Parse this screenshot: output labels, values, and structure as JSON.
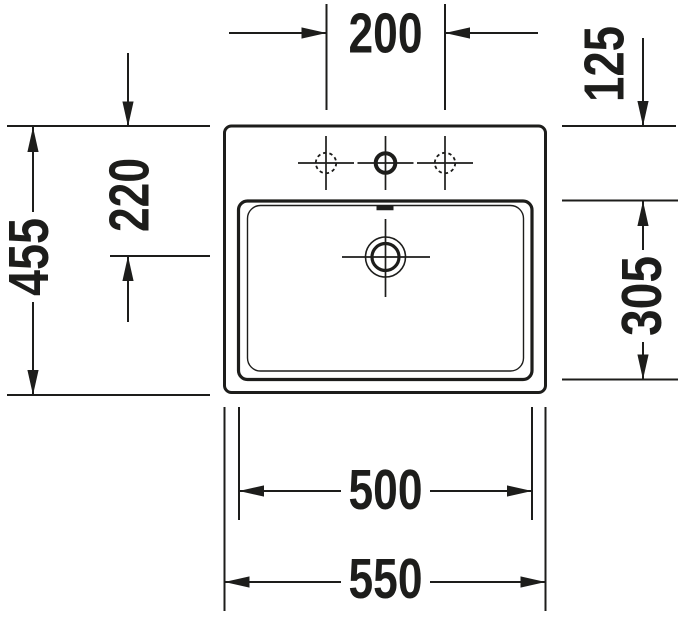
{
  "drawing": {
    "kind": "washbasin-top-view-technical-drawing",
    "background_color": "#ffffff",
    "line_color": "#1d1d1b",
    "dims": {
      "top_center": "200",
      "top_right": "125",
      "left_outer": "455",
      "left_inner": "220",
      "right_side": "305",
      "bottom_inner": "500",
      "bottom_outer": "550"
    }
  }
}
